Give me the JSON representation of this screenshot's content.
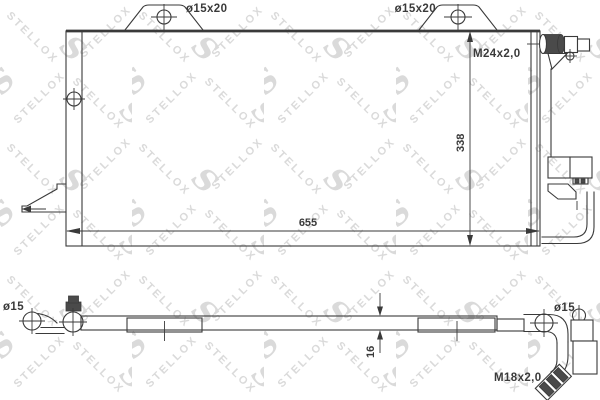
{
  "title": "Condenser technical drawing",
  "watermark": {
    "text": "STELLOX",
    "logo": "S"
  },
  "colors": {
    "line": "#3a3a3a",
    "dark_fill": "#4a4a4a",
    "watermark": "#dadada",
    "background": "#ffffff"
  },
  "top_view": {
    "bracket_left_label": "ø15x20",
    "bracket_right_label": "ø15x20",
    "fitting_label": "M24x2,0",
    "height_dimension": "338",
    "width_dimension": "655"
  },
  "bottom_view": {
    "left_port_label": "ø15",
    "thickness_dimension": "16",
    "right_port_label": "ø15",
    "fitting_label": "M18x2,0"
  }
}
